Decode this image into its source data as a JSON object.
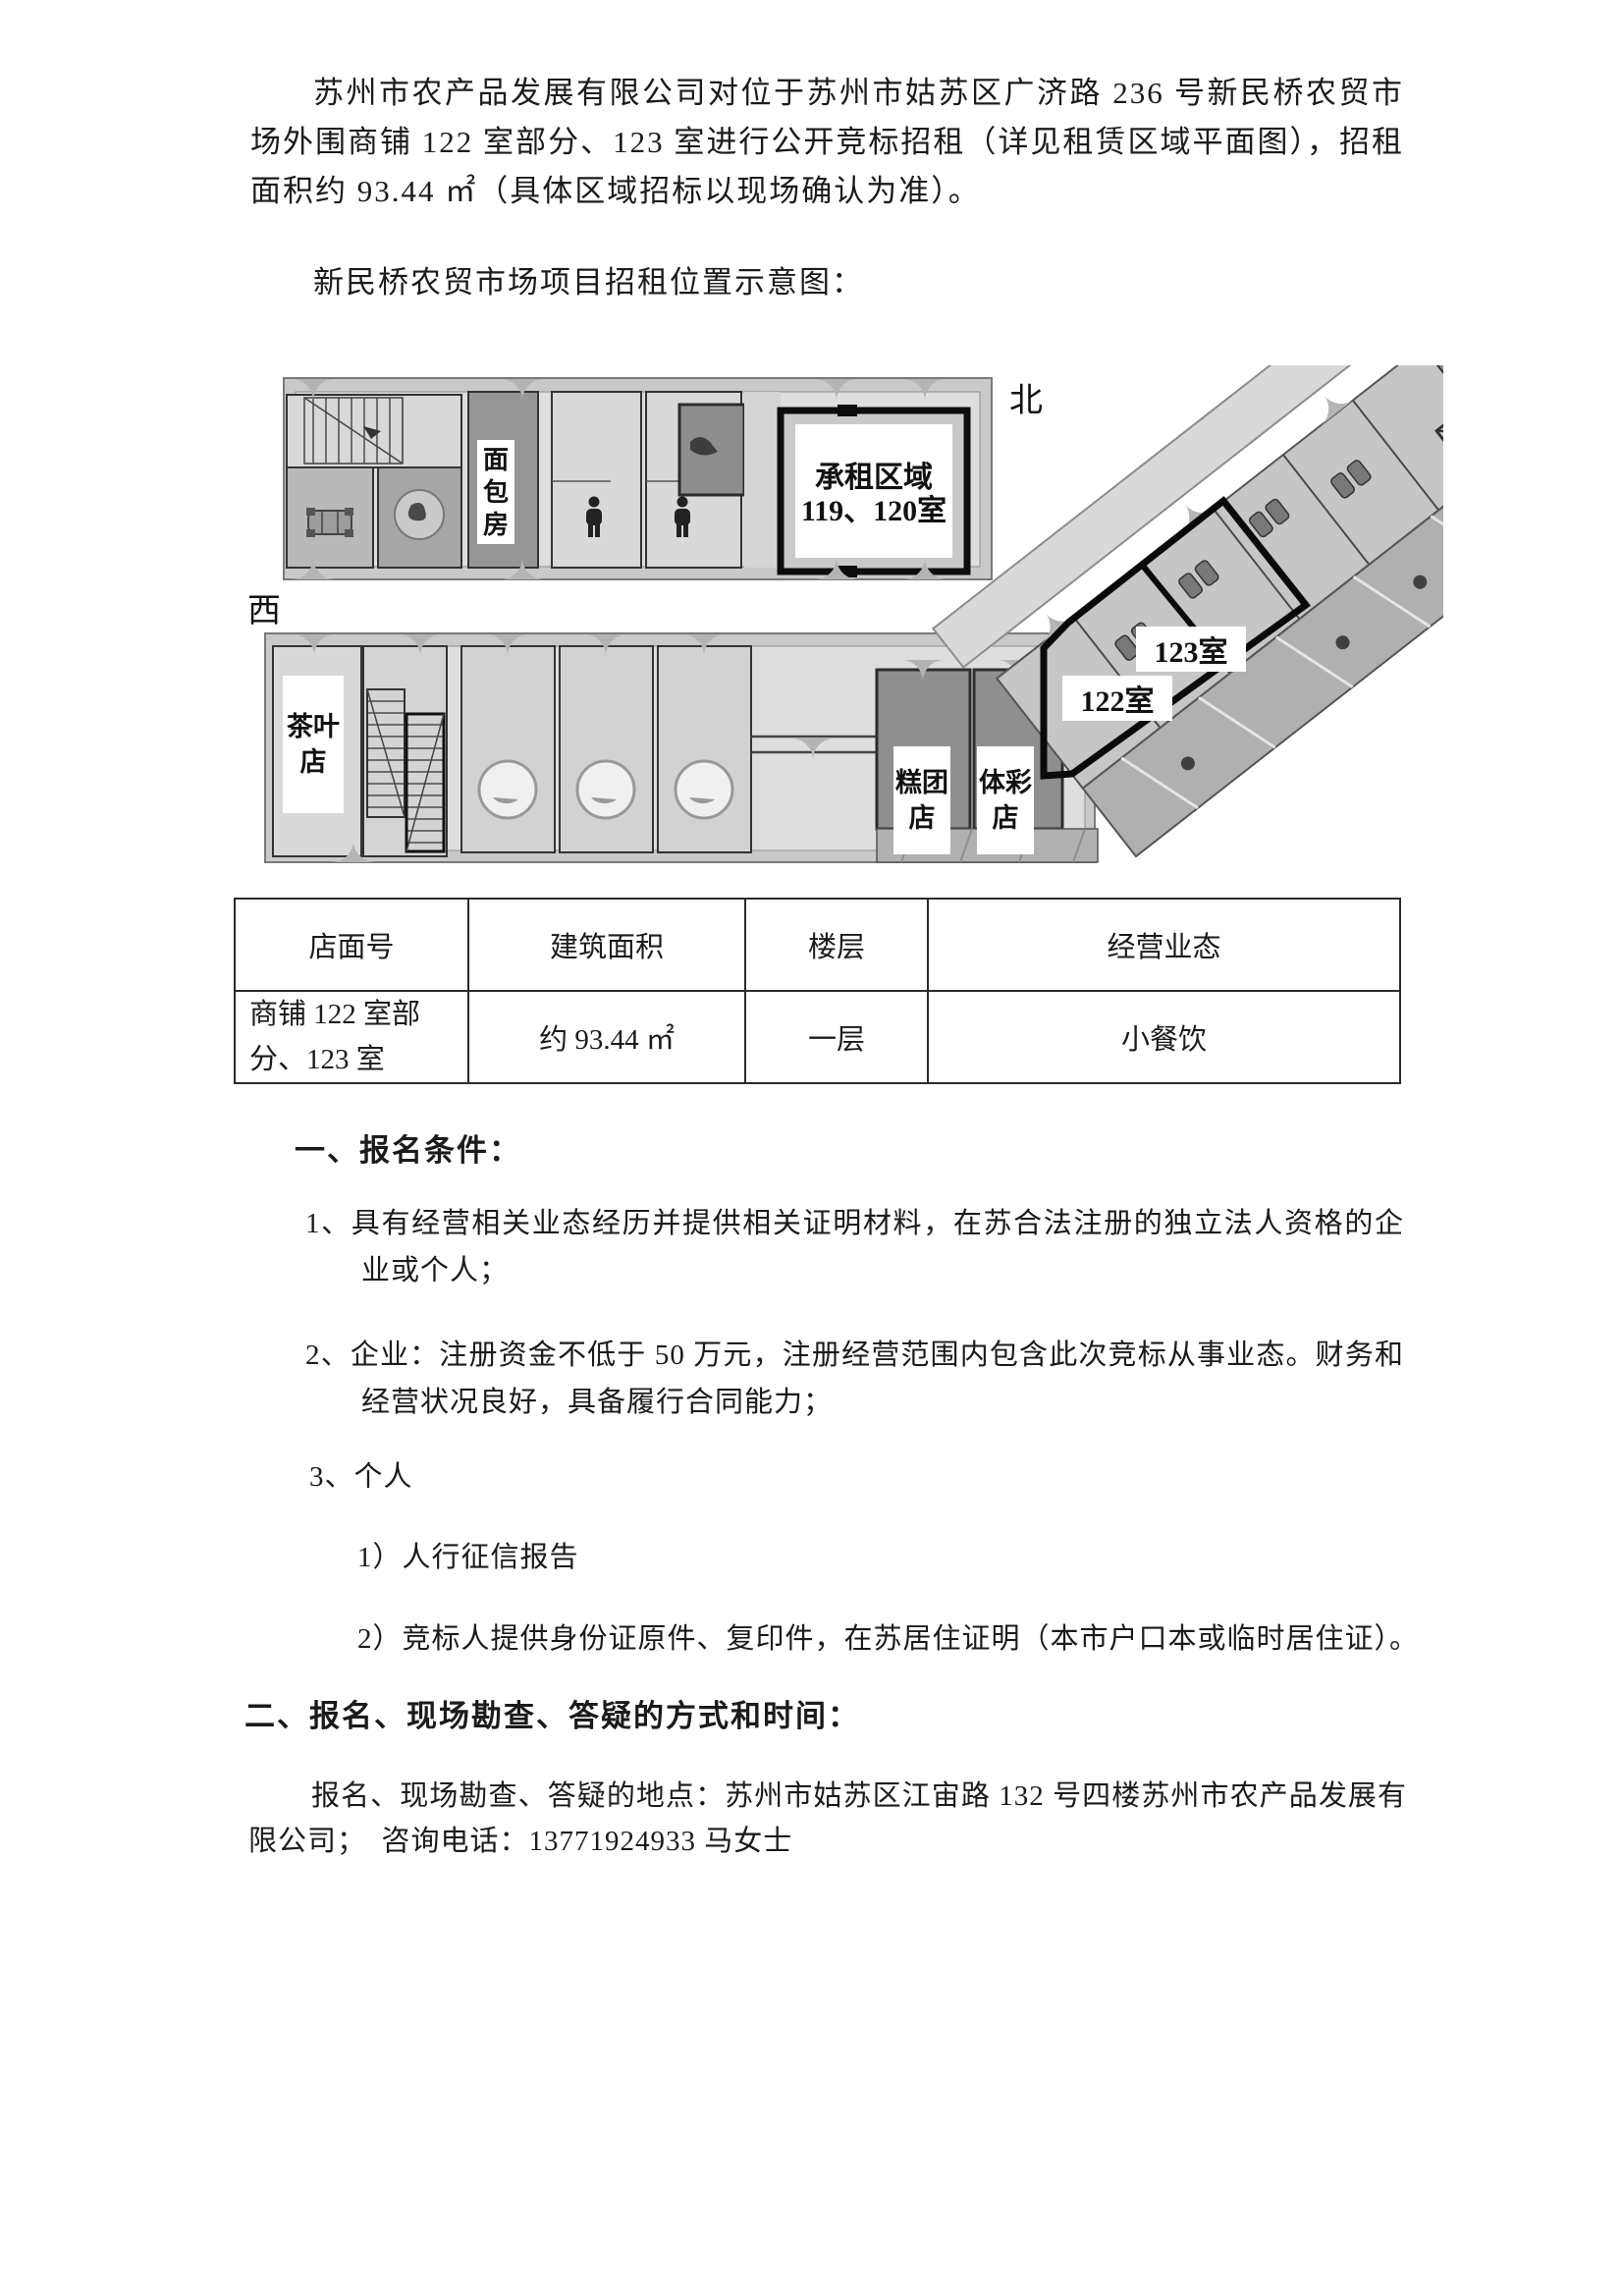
{
  "document": {
    "intro_paragraph": "苏州市农产品发展有限公司对位于苏州市姑苏区广济路 236 号新民桥农贸市场外围商铺 122 室部分、123 室进行公开竞标招租（详见租赁区域平面图），招租面积约 93.44 ㎡（具体区域招标以现场确认为准）。",
    "diagram_caption": "新民桥农贸市场项目招租位置示意图："
  },
  "floor_plan": {
    "north_label": "北",
    "west_label": "西",
    "bakery_label": "面包房",
    "leased_area_line1": "承租区域",
    "leased_area_line2": "119、120室",
    "tea_shop_label": "茶叶店",
    "cake_shop_label": "糕团店",
    "lottery_shop_label": "体彩店",
    "room_122_label": "122室",
    "room_123_label": "123室"
  },
  "table": {
    "headers": [
      "店面号",
      "建筑面积",
      "楼层",
      "经营业态"
    ],
    "row": [
      "商铺 122 室部分、123 室",
      "约 93.44 ㎡",
      "一层",
      "小餐饮"
    ]
  },
  "section_one": {
    "heading": "一、报名条件：",
    "item_1": "1、具有经营相关业态经历并提供相关证明材料，在苏合法注册的独立法人资格的企业或个人；",
    "item_2": "2、企业：注册资金不低于 50 万元，注册经营范围内包含此次竞标从事业态。财务和经营状况良好，具备履行合同能力；",
    "item_3": "3、个人",
    "subitem_1": "1）人行征信报告",
    "subitem_2": "2）竞标人提供身份证原件、复印件，在苏居住证明（本市户口本或临时居住证）。"
  },
  "section_two": {
    "heading": "二、报名、现场勘查、答疑的方式和时间：",
    "contact_paragraph": "报名、现场勘查、答疑的地点：苏州市姑苏区江宙路 132 号四楼苏州市农产品发展有限公司；　咨询电话：13771924933  马女士"
  }
}
